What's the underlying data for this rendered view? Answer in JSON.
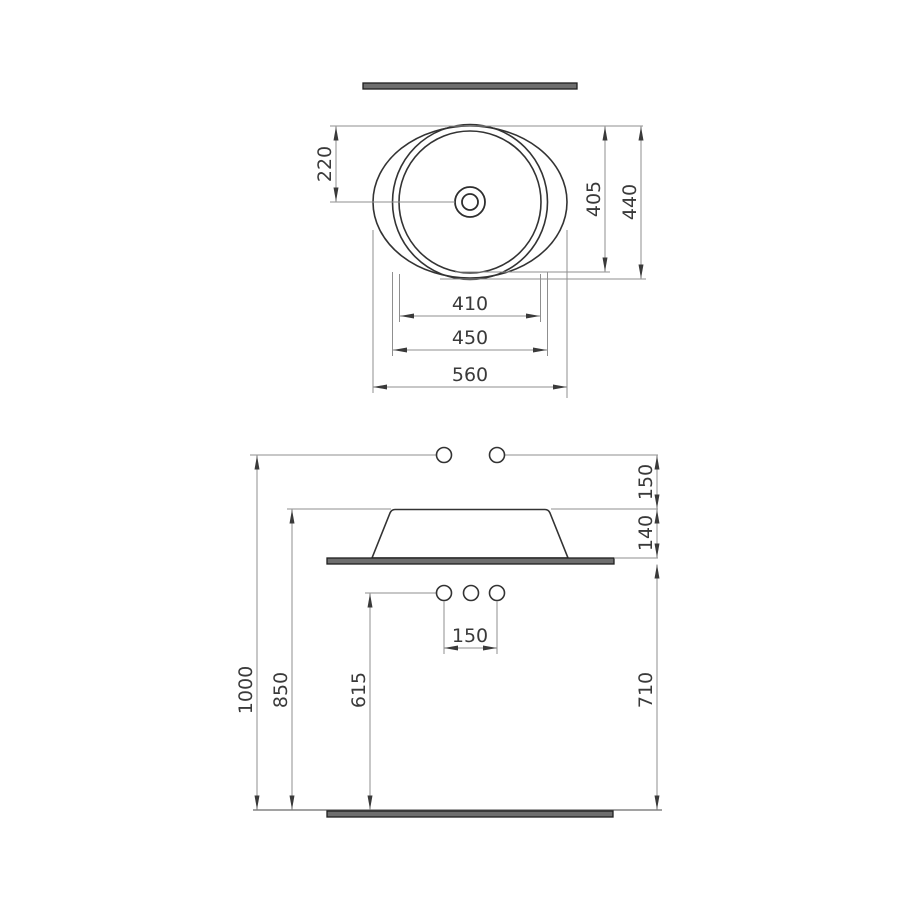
{
  "drawing": {
    "subject": "countertop-washbasin-technical-drawing",
    "views": {
      "top": {
        "name": "top-view",
        "dims": {
          "basin_half_height": "220",
          "inner_height": "405",
          "overall_height": "440",
          "inner_diameter": "410",
          "rim_diameter": "450",
          "overall_width": "560"
        }
      },
      "front": {
        "name": "front-view",
        "dims": {
          "faucet_above_rim": "150",
          "basin_height": "140",
          "faucet_height": "1000",
          "rim_height": "850",
          "supply_height": "615",
          "counter_height": "710",
          "hole_spacing": "150"
        }
      }
    },
    "colors": {
      "background": "#ffffff",
      "object_line": "#333333",
      "dimension_line": "#8f8f8f",
      "bar_fill": "#6e6e6e",
      "bar_stroke": "#1f1f1f",
      "text": "#3a3a3a"
    }
  }
}
